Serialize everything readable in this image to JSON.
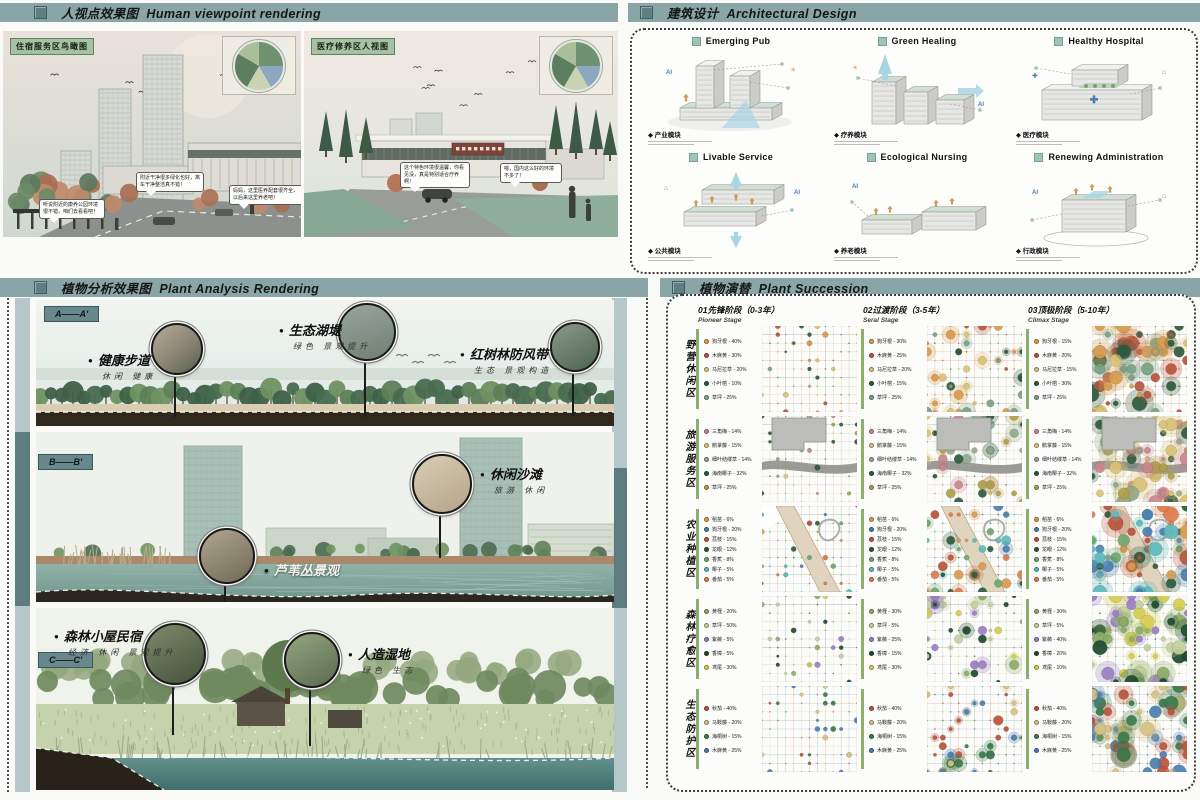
{
  "headers": {
    "human_viewpoint": {
      "zh": "人视点效果图",
      "en": "Human viewpoint rendering"
    },
    "architectural_design": {
      "zh": "建筑设计",
      "en": "Architectural  Design"
    },
    "plant_analysis": {
      "zh": "植物分析效果图",
      "en": "Plant Analysis Rendering"
    },
    "plant_succession": {
      "zh": "植物演替",
      "en": "Plant Succession"
    }
  },
  "human_viewpoint": {
    "renderings": [
      {
        "tag": "住宿服务区鸟瞰图",
        "bubbles": [
          "听说附近的康养公园环境很不错，咱们去看看吧！",
          "附近干净很多绿化也好，离车干净整洁真不错！",
          "妈妈，这里医养配套很齐全，以后来这里养老吧！"
        ]
      },
      {
        "tag": "医疗修养区人视图",
        "bubbles": [
          "这个特色环境很温馨，你看见没，真是特别适合疗养啊！",
          "嗯，国内这么好的环境不多了！"
        ],
        "sign": "医养康复医疗中心"
      }
    ]
  },
  "architectural_design": {
    "modules": [
      {
        "title": "Emerging Pub",
        "label": "产业模块",
        "shape": "towers"
      },
      {
        "title": "Green Healing",
        "label": "疗养模块",
        "shape": "healing"
      },
      {
        "title": "Healthy Hospital",
        "label": "医疗模块",
        "shape": "hospital"
      },
      {
        "title": "Livable Service",
        "label": "公共模块",
        "shape": "service"
      },
      {
        "title": "Ecological Nursing",
        "label": "养老模块",
        "shape": "nursing"
      },
      {
        "title": "Renewing Administration",
        "label": "行政模块",
        "shape": "admin"
      }
    ]
  },
  "plant_analysis": {
    "sections": [
      {
        "tag": "A——A'",
        "callouts": [
          {
            "name": "健康步道",
            "sub": "休闲  健康"
          },
          {
            "name": "生态湖堤",
            "sub": "绿色  景观提升"
          },
          {
            "name": "红树林防风带",
            "sub": "生态  景观构造"
          }
        ]
      },
      {
        "tag": "B——B'",
        "callouts": [
          {
            "name": "休闲沙滩",
            "sub": "旅游  休闲"
          },
          {
            "name": "芦苇丛景观",
            "sub": ""
          }
        ]
      },
      {
        "tag": "C——C'",
        "callouts": [
          {
            "name": "森林小屋民宿",
            "sub": "经济  休闲  景观提升"
          },
          {
            "name": "人造湿地",
            "sub": "绿色  生态"
          }
        ]
      }
    ]
  },
  "plant_succession": {
    "stages": [
      {
        "title": "01先锋阶段（0-3年）",
        "en": "Pioneer Stage"
      },
      {
        "title": "02过渡阶段（3-5年）",
        "en": "Seral Stage"
      },
      {
        "title": "03顶极阶段（5-10年）",
        "en": "Climax Stage"
      }
    ],
    "stage_cfg": [
      {
        "dots": 24,
        "rmin": 1.2,
        "rmax": 3.0,
        "halo": 0.0
      },
      {
        "dots": 40,
        "rmin": 1.6,
        "rmax": 5.0,
        "halo": 0.5
      },
      {
        "dots": 55,
        "rmin": 2.0,
        "rmax": 7.5,
        "halo": 0.65
      }
    ],
    "zones": [
      {
        "label": "野营休闲区",
        "overlay": "none",
        "palette": [
          "#d99a4e",
          "#b9543c",
          "#d9c175",
          "#2e5a3c",
          "#7ba183"
        ],
        "legend": [
          {
            "name": "狗牙根",
            "color": "#d99a4e",
            "pcts": [
              40,
              30,
              15
            ]
          },
          {
            "name": "木麻黄",
            "color": "#b9543c",
            "pcts": [
              30,
              25,
              20
            ]
          },
          {
            "name": "马尼拉草",
            "color": "#d9c175",
            "pcts": [
              20,
              20,
              15
            ]
          },
          {
            "name": "小叶榕",
            "color": "#2e5a3c",
            "pcts": [
              10,
              15,
              30
            ]
          },
          {
            "name": "草坪",
            "color": "#7ba183",
            "pcts": [
              25,
              25,
              25
            ]
          }
        ]
      },
      {
        "label": "旅游服务区",
        "overlay": "resort",
        "palette": [
          "#c9858d",
          "#d9c175",
          "#8fa98f",
          "#2e5a3c",
          "#aea04a"
        ],
        "legend": [
          {
            "name": "三角梅",
            "color": "#c9858d",
            "pcts": [
              14,
              14,
              14
            ]
          },
          {
            "name": "鹅掌藤",
            "color": "#d9c175",
            "pcts": [
              15,
              15,
              15
            ]
          },
          {
            "name": "细叶结缕草",
            "color": "#8fa98f",
            "pcts": [
              14,
              14,
              14
            ]
          },
          {
            "name": "海南椰子",
            "color": "#2e5a3c",
            "pcts": [
              32,
              32,
              32
            ]
          },
          {
            "name": "草坪",
            "color": "#aea04a",
            "pcts": [
              25,
              25,
              25
            ]
          }
        ]
      },
      {
        "label": "农业种植区",
        "overlay": "farm",
        "palette": [
          "#d99a4e",
          "#4a7eb0",
          "#b9543c",
          "#2e5a3c",
          "#6da86d",
          "#5cbabc",
          "#dd7b4b"
        ],
        "legend": [
          {
            "name": "稻苗",
            "color": "#d99a4e",
            "pcts": [
              6,
              6,
              6
            ]
          },
          {
            "name": "狗牙根",
            "color": "#4a7eb0",
            "pcts": [
              20,
              20,
              20
            ]
          },
          {
            "name": "荔枝",
            "color": "#b9543c",
            "pcts": [
              15,
              15,
              15
            ]
          },
          {
            "name": "龙眼",
            "color": "#2e5a3c",
            "pcts": [
              12,
              12,
              12
            ]
          },
          {
            "name": "香蕉",
            "color": "#6da86d",
            "pcts": [
              8,
              8,
              8
            ]
          },
          {
            "name": "椰子",
            "color": "#5cbabc",
            "pcts": [
              5,
              5,
              5
            ]
          },
          {
            "name": "番茄",
            "color": "#dd7b4b",
            "pcts": [
              5,
              5,
              5
            ]
          }
        ]
      },
      {
        "label": "森林疗愈区",
        "overlay": "none",
        "palette": [
          "#8cab66",
          "#c4cf9d",
          "#9a7ec2",
          "#1e4a2e",
          "#d5cd50"
        ],
        "legend": [
          {
            "name": "黄槿",
            "color": "#8cab66",
            "pcts": [
              20,
              30,
              30
            ]
          },
          {
            "name": "草坪",
            "color": "#c4cf9d",
            "pcts": [
              50,
              5,
              5
            ]
          },
          {
            "name": "紫薇",
            "color": "#9a7ec2",
            "pcts": [
              5,
              25,
              40
            ]
          },
          {
            "name": "香樟",
            "color": "#1e4a2e",
            "pcts": [
              5,
              15,
              20
            ]
          },
          {
            "name": "鸢尾",
            "color": "#d5cd50",
            "pcts": [
              30,
              30,
              10
            ]
          }
        ]
      },
      {
        "label": "生态防护区",
        "overlay": "none",
        "palette": [
          "#b9543c",
          "#d7c183",
          "#3a7a4b",
          "#4a7eb0"
        ],
        "legend": [
          {
            "name": "秋茄",
            "color": "#b9543c",
            "pcts": [
              40,
              40,
              40
            ]
          },
          {
            "name": "马鞍藤",
            "color": "#d7c183",
            "pcts": [
              20,
              20,
              20
            ]
          },
          {
            "name": "海桐树",
            "color": "#3a7a4b",
            "pcts": [
              15,
              15,
              15
            ]
          },
          {
            "name": "木麻黄",
            "color": "#4a7eb0",
            "pcts": [
              25,
              25,
              25
            ]
          }
        ]
      }
    ]
  }
}
